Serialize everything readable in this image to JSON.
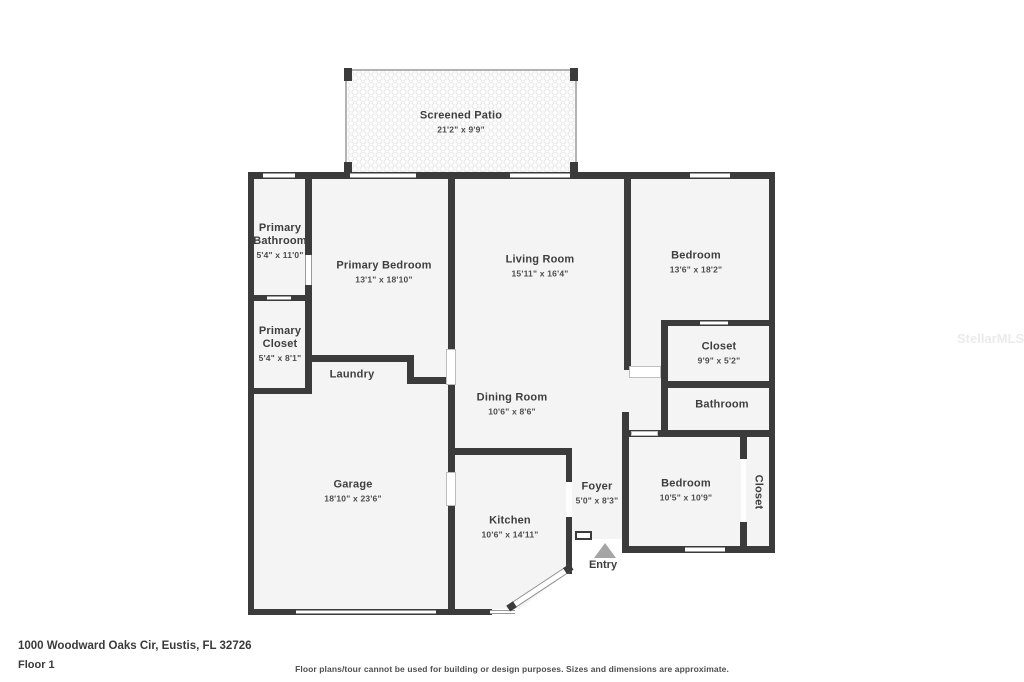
{
  "address": "1000 Woodward Oaks Cir, Eustis, FL 32726",
  "floor_label": "Floor 1",
  "disclaimer": "Floor plans/tour cannot be used for building or design purposes. Sizes and dimensions are approximate.",
  "watermark": "StellarMLS",
  "entry_label": "Entry",
  "colors": {
    "wall": "#3b3b3b",
    "floor": "#f4f4f4",
    "text": "#3e3e3e"
  },
  "rooms": {
    "screened_patio": {
      "name": "Screened Patio",
      "dims": "21'2\" x 9'9\""
    },
    "primary_bathroom": {
      "name": "Primary Bathroom",
      "dims": "5'4\" x 11'0\""
    },
    "primary_bedroom": {
      "name": "Primary Bedroom",
      "dims": "13'1\" x 18'10\""
    },
    "living_room": {
      "name": "Living Room",
      "dims": "15'11\" x 16'4\""
    },
    "bedroom_upper": {
      "name": "Bedroom",
      "dims": "13'6\" x 18'2\""
    },
    "primary_closet": {
      "name": "Primary Closet",
      "dims": "5'4\" x 8'1\""
    },
    "laundry": {
      "name": "Laundry",
      "dims": ""
    },
    "closet_upper": {
      "name": "Closet",
      "dims": "9'9\" x 5'2\""
    },
    "bathroom": {
      "name": "Bathroom",
      "dims": ""
    },
    "dining_room": {
      "name": "Dining Room",
      "dims": "10'6\" x 8'6\""
    },
    "garage": {
      "name": "Garage",
      "dims": "18'10\" x 23'6\""
    },
    "foyer": {
      "name": "Foyer",
      "dims": "5'0\" x 8'3\""
    },
    "bedroom_lower": {
      "name": "Bedroom",
      "dims": "10'5\" x 10'9\""
    },
    "closet_lower": {
      "name": "Closet",
      "dims": ""
    },
    "kitchen": {
      "name": "Kitchen",
      "dims": "10'6\" x 14'11\""
    }
  }
}
